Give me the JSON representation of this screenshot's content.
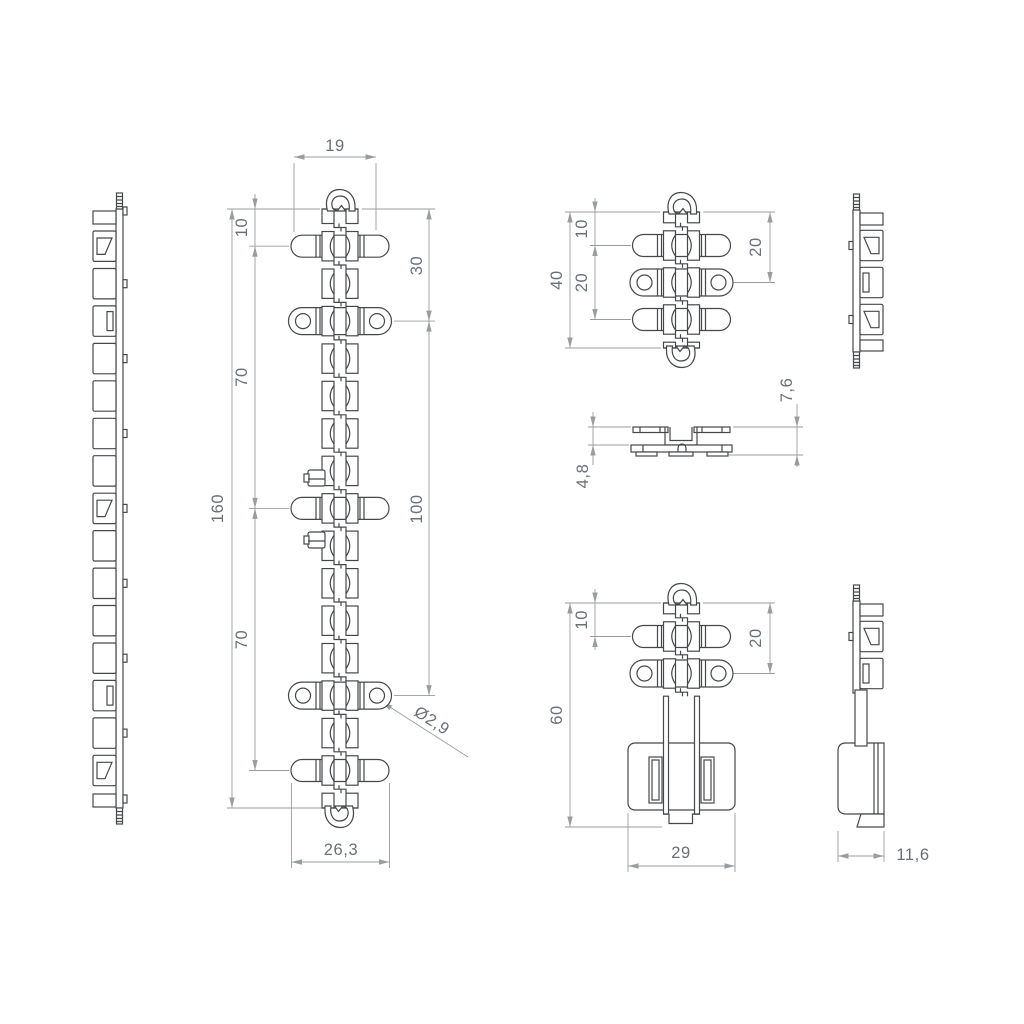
{
  "document_type": "technical-drawing",
  "colors": {
    "background": "#ffffff",
    "part_line": "#45484b",
    "dim_line": "#9a9da0",
    "dim_text": "#697077"
  },
  "views": {
    "front_main": {
      "label": "front-view-160",
      "dims": {
        "top_width": "19",
        "offset_top": "10",
        "ear_offset": "30",
        "pitch_upper": "70",
        "overall_length": "160",
        "pitch_lower": "70",
        "ear_span": "100",
        "hole_diameter": "Ø2,9",
        "bottom_width": "26,3"
      }
    },
    "front_short": {
      "label": "front-view-40",
      "dims": {
        "offset_top": "10",
        "pitch": "20",
        "overall_length": "40",
        "ear_offset": "20"
      }
    },
    "section": {
      "label": "section-view",
      "dims": {
        "height_total": "7,6",
        "height_base": "4,8"
      }
    },
    "front_bracket": {
      "label": "front-view-60",
      "dims": {
        "offset_top": "10",
        "overall_length": "60",
        "ear_offset": "20",
        "base_width": "29"
      }
    },
    "side_bracket": {
      "label": "side-view-60",
      "dims": {
        "depth": "11,6"
      }
    }
  }
}
